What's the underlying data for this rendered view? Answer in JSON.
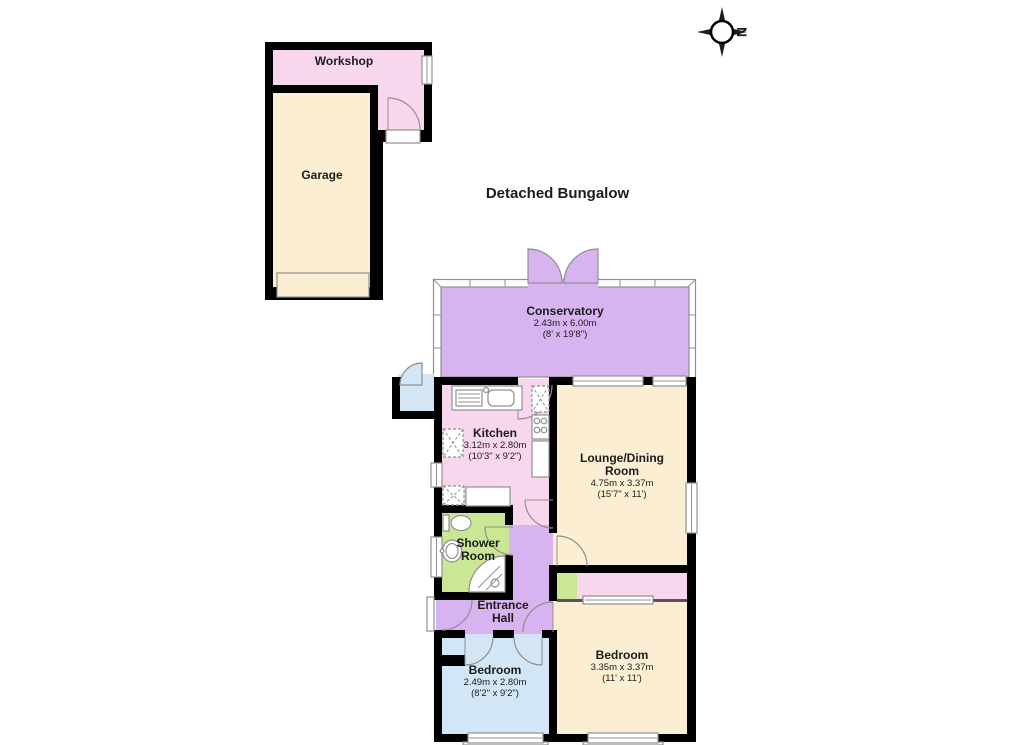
{
  "title": "Detached Bungalow",
  "compass": {
    "direction": "N"
  },
  "outbuildings": {
    "workshop": {
      "name": "Workshop"
    },
    "garage": {
      "name": "Garage"
    }
  },
  "rooms": {
    "conservatory": {
      "name": "Conservatory",
      "metric": "2.43m x 6.00m",
      "imperial": "(8' x 19'8\")"
    },
    "kitchen": {
      "name": "Kitchen",
      "metric": "3.12m x 2.80m",
      "imperial": "(10'3\" x 9'2\")"
    },
    "lounge_dining": {
      "name": "Lounge/Dining Room",
      "metric": "4.75m x 3.37m",
      "imperial": "(15'7\" x 11')"
    },
    "shower_room": {
      "name": "Shower Room"
    },
    "entrance_hall": {
      "name": "Entrance Hall"
    },
    "bedroom_main": {
      "name": "Bedroom",
      "metric": "3.35m x 3.37m",
      "imperial": "(11' x 11')"
    },
    "bedroom_second": {
      "name": "Bedroom",
      "metric": "2.49m x 2.80m",
      "imperial": "(8'2\" x 9'2\")"
    }
  },
  "colors": {
    "pink": "#f8d7ee",
    "cream": "#fbeed3",
    "purple": "#d7b3ef",
    "green": "#c9e795",
    "blue": "#d3e6f5",
    "wall": "#000000",
    "frame": "#909090"
  }
}
